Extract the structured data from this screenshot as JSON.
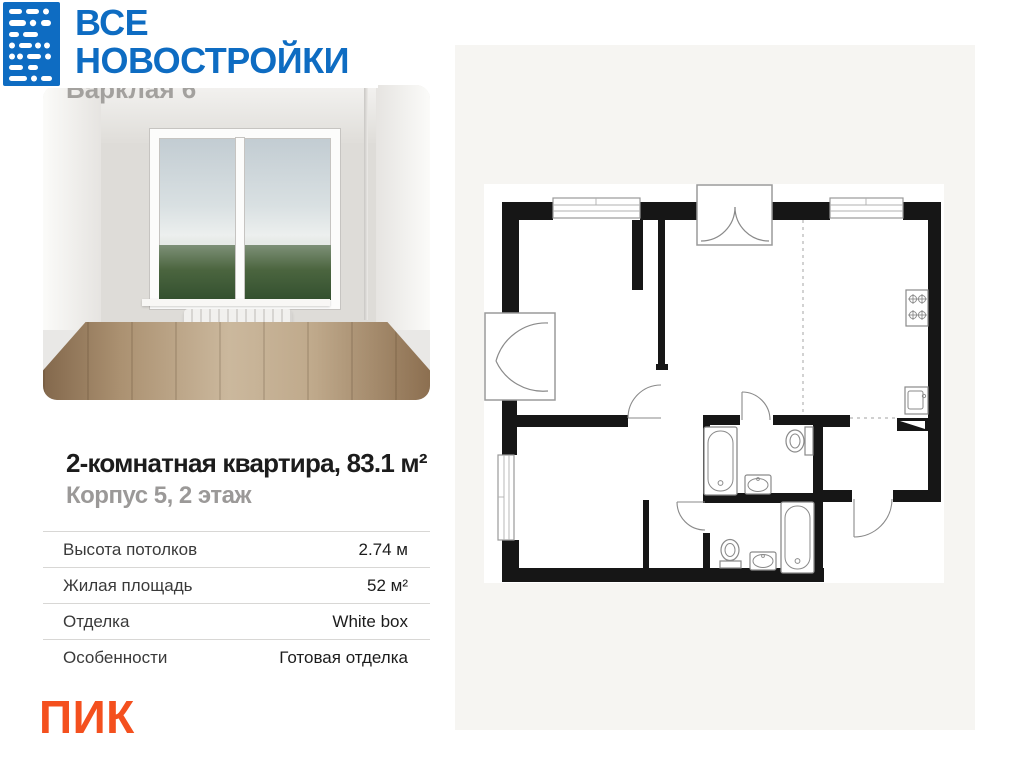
{
  "brand": {
    "line1": "ВСЕ",
    "line2": "НОВОСТРОЙКИ",
    "color": "#0e6cc2",
    "icon": "morse-dots-logo"
  },
  "photo": {
    "project_label": "Барклая 6"
  },
  "listing": {
    "title": "2-комнатная квартира, 83.1 м²",
    "subtitle": "Корпус 5, 2 этаж"
  },
  "details": {
    "rows": [
      {
        "label": "Высота потолков",
        "value": "2.74 м"
      },
      {
        "label": "Жилая площадь",
        "value": "52 м²"
      },
      {
        "label": "Отделка",
        "value": "White box"
      },
      {
        "label": "Особенности",
        "value": "Готовая отделка"
      }
    ]
  },
  "developer": {
    "name": "ПИК",
    "color": "#f4501e"
  },
  "floorplan": {
    "fixtures": [
      "window",
      "entrance-double-door",
      "balcony-double-door",
      "bathtub",
      "toilet",
      "sink",
      "stove",
      "kitchen-sink"
    ]
  }
}
